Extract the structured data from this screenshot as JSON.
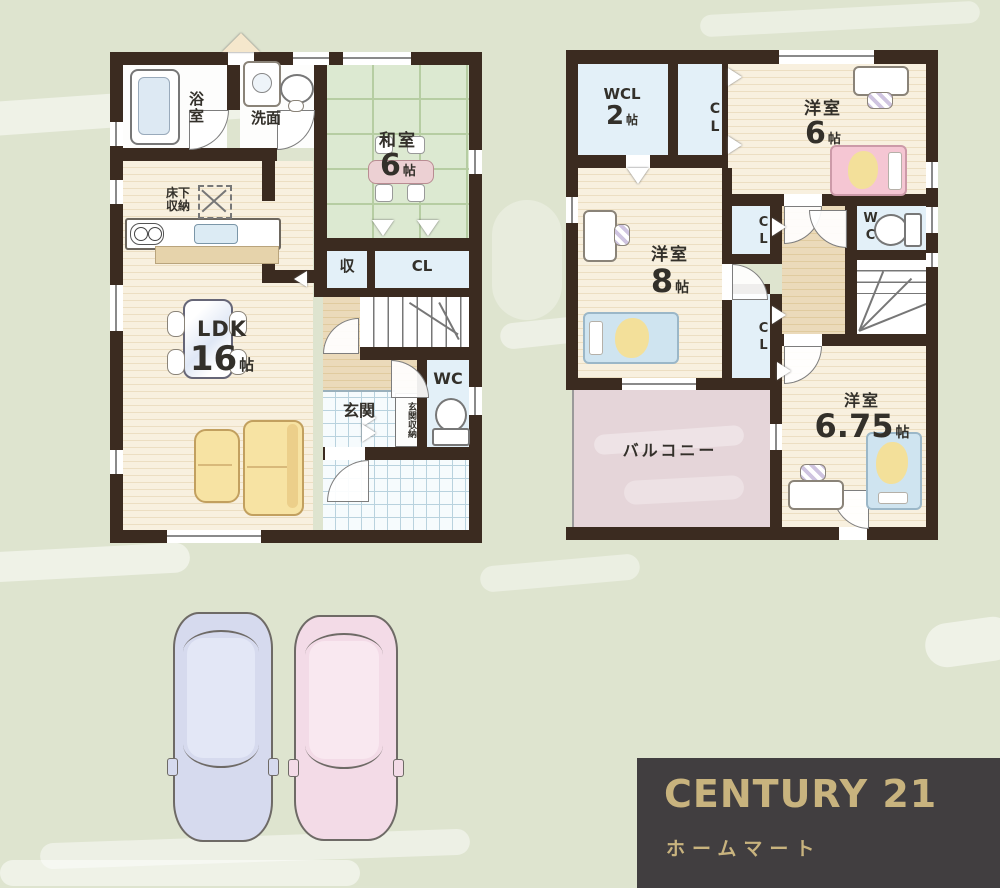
{
  "palette": {
    "background": "#dee4cf",
    "wall": "#3b2b20",
    "wood_floor": "#f8f0df",
    "tatami_green": "#dce9d1",
    "closet_blue": "#e3f0f8",
    "hall_tan": "#ebdaba",
    "balcony_pink": "#e5d5d9",
    "tile_white": "#f6fbfd",
    "sofa_yellow": "#f7e3a3",
    "car_blue": "#d6daee",
    "car_pink": "#f3dbe7",
    "logo_background": "#413e40",
    "logo_gold": "#c8b37e"
  },
  "floor1": {
    "bath": "浴室",
    "washroom": "洗面",
    "japanese_room": {
      "name": "和室",
      "size": "6",
      "unit": "帖"
    },
    "underfloor_storage": {
      "line1": "床下",
      "line2": "収納"
    },
    "ldk": {
      "name": "LDK",
      "size": "16",
      "unit": "帖"
    },
    "storage": "収",
    "closet": "CL",
    "toilet": "WC",
    "entrance": "玄関",
    "entrance_storage": "玄関収納"
  },
  "floor2": {
    "walk_in_closet": {
      "name": "WCL",
      "size": "2",
      "unit": "帖"
    },
    "closet_top": "CL",
    "bedroom6": {
      "name": "洋室",
      "size": "6",
      "unit": "帖"
    },
    "bedroom8": {
      "name": "洋室",
      "size": "8",
      "unit": "帖"
    },
    "closet_mid": "CL",
    "toilet": "WC",
    "closet_low": "CL",
    "balcony": "バルコニー",
    "bedroom675": {
      "name": "洋室",
      "size": "6.75",
      "unit": "帖"
    }
  },
  "logo": {
    "brand": "CENTURY 21",
    "shop_name": "ホームマート"
  }
}
